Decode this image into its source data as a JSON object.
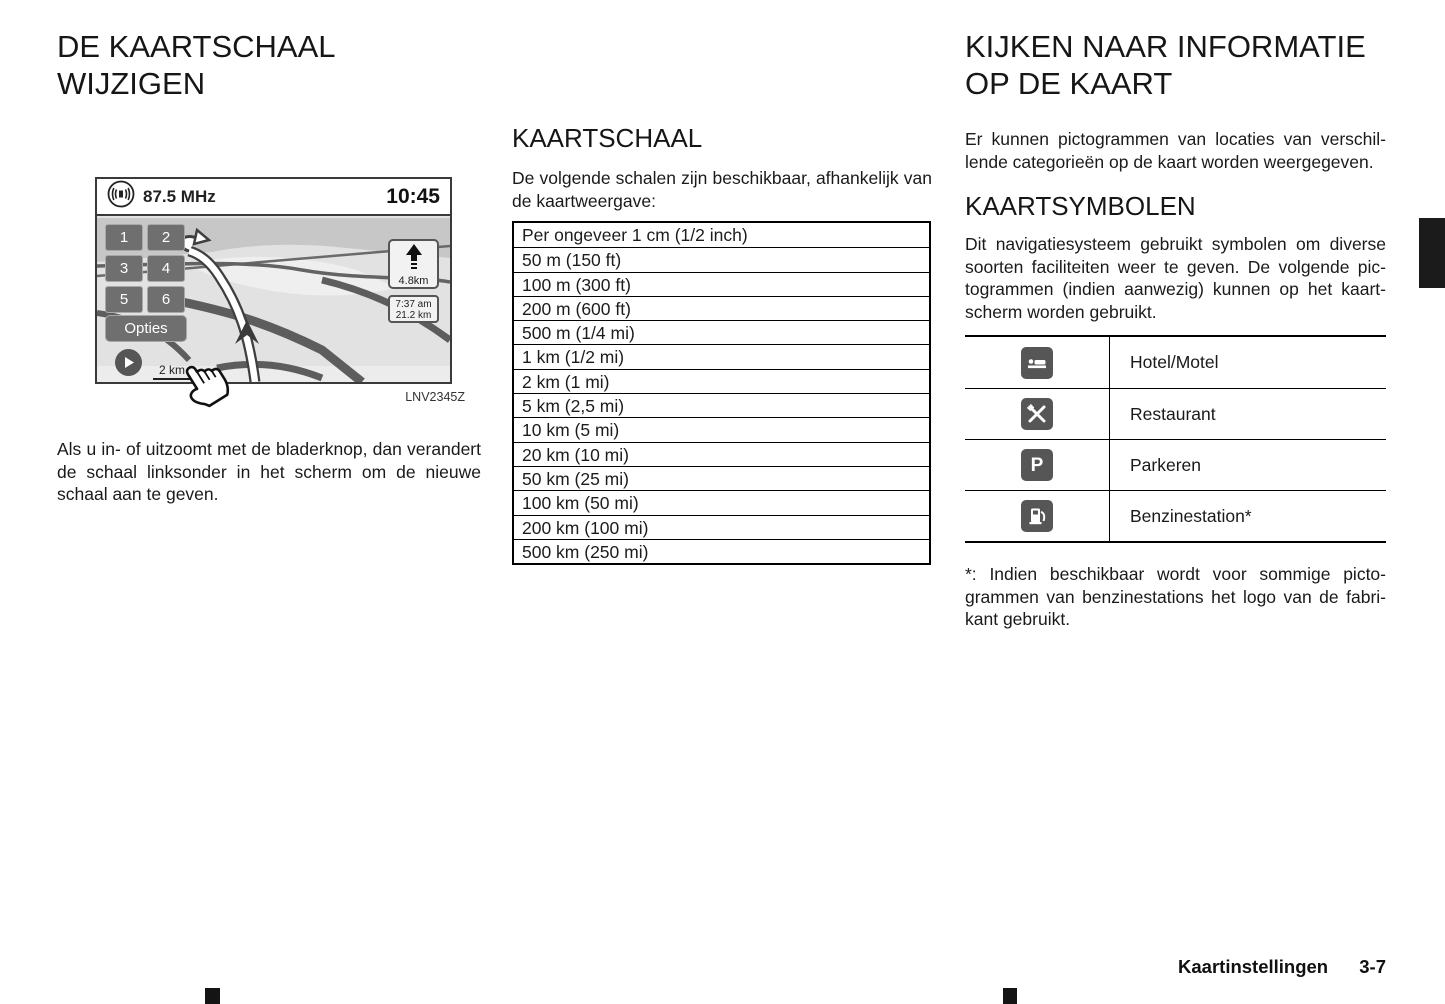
{
  "left": {
    "heading": "DE KAARTSCHAAL WIJZIGEN",
    "figure": {
      "radio_frequency": "87.5 MHz",
      "clock": "10:45",
      "keys": [
        "1",
        "2",
        "3",
        "4",
        "5",
        "6"
      ],
      "options_button": "Opties",
      "turn_distance": "4.8km",
      "eta_time": "7:37 am",
      "eta_distance": "21.2 km",
      "map_scale": "2 km",
      "caption": "LNV2345Z"
    },
    "paragraph": "Als u in- of uitzoomt met de bladerknop, dan veran­dert de schaal linksonder in het scherm om de nieuwe schaal aan te geven."
  },
  "middle": {
    "heading": "KAARTSCHAAL",
    "intro": "De volgende schalen zijn beschikbaar, afhankelijk van de kaartweergave:",
    "scale_rows": [
      "Per ongeveer 1 cm (1/2 inch)",
      "50 m (150 ft)",
      "100 m (300 ft)",
      "200 m (600 ft)",
      "500 m (1/4 mi)",
      "1 km (1/2 mi)",
      "2 km (1 mi)",
      "5 km (2,5 mi)",
      "10 km (5 mi)",
      "20 km (10 mi)",
      "50 km (25 mi)",
      "100 km (50 mi)",
      "200 km (100 mi)",
      "500 km (250 mi)"
    ]
  },
  "right": {
    "heading": "KIJKEN NAAR INFORMATIE OP DE KAART",
    "intro": "Er kunnen pictogrammen van locaties van verschil­lende categorieën op de kaart worden weergege­ven.",
    "subheading": "KAARTSYMBOLEN",
    "body": "Dit navigatiesysteem gebruikt symbolen om diverse soorten faciliteiten weer te geven. De volgende pic­togrammen (indien aanwezig) kunnen op het kaart­scherm worden gebruikt.",
    "symbols": [
      {
        "icon": "bed-icon",
        "label": "Hotel/Motel"
      },
      {
        "icon": "crossed-utensils-icon",
        "label": "Restaurant"
      },
      {
        "icon": "parking-icon",
        "label": "Parkeren",
        "glyph": "P"
      },
      {
        "icon": "fuel-pump-icon",
        "label": "Benzinestation*"
      }
    ],
    "footnote": "*: Indien beschikbaar wordt voor sommige picto­grammen van benzinestations het logo van de fabri­kant gebruikt."
  },
  "footer": {
    "section": "Kaartinstellingen",
    "page_number": "3-7"
  },
  "colors": {
    "icon_badge": "#565656",
    "nav_button": "#6f6f6f",
    "map_background": "#e2e2e2"
  }
}
